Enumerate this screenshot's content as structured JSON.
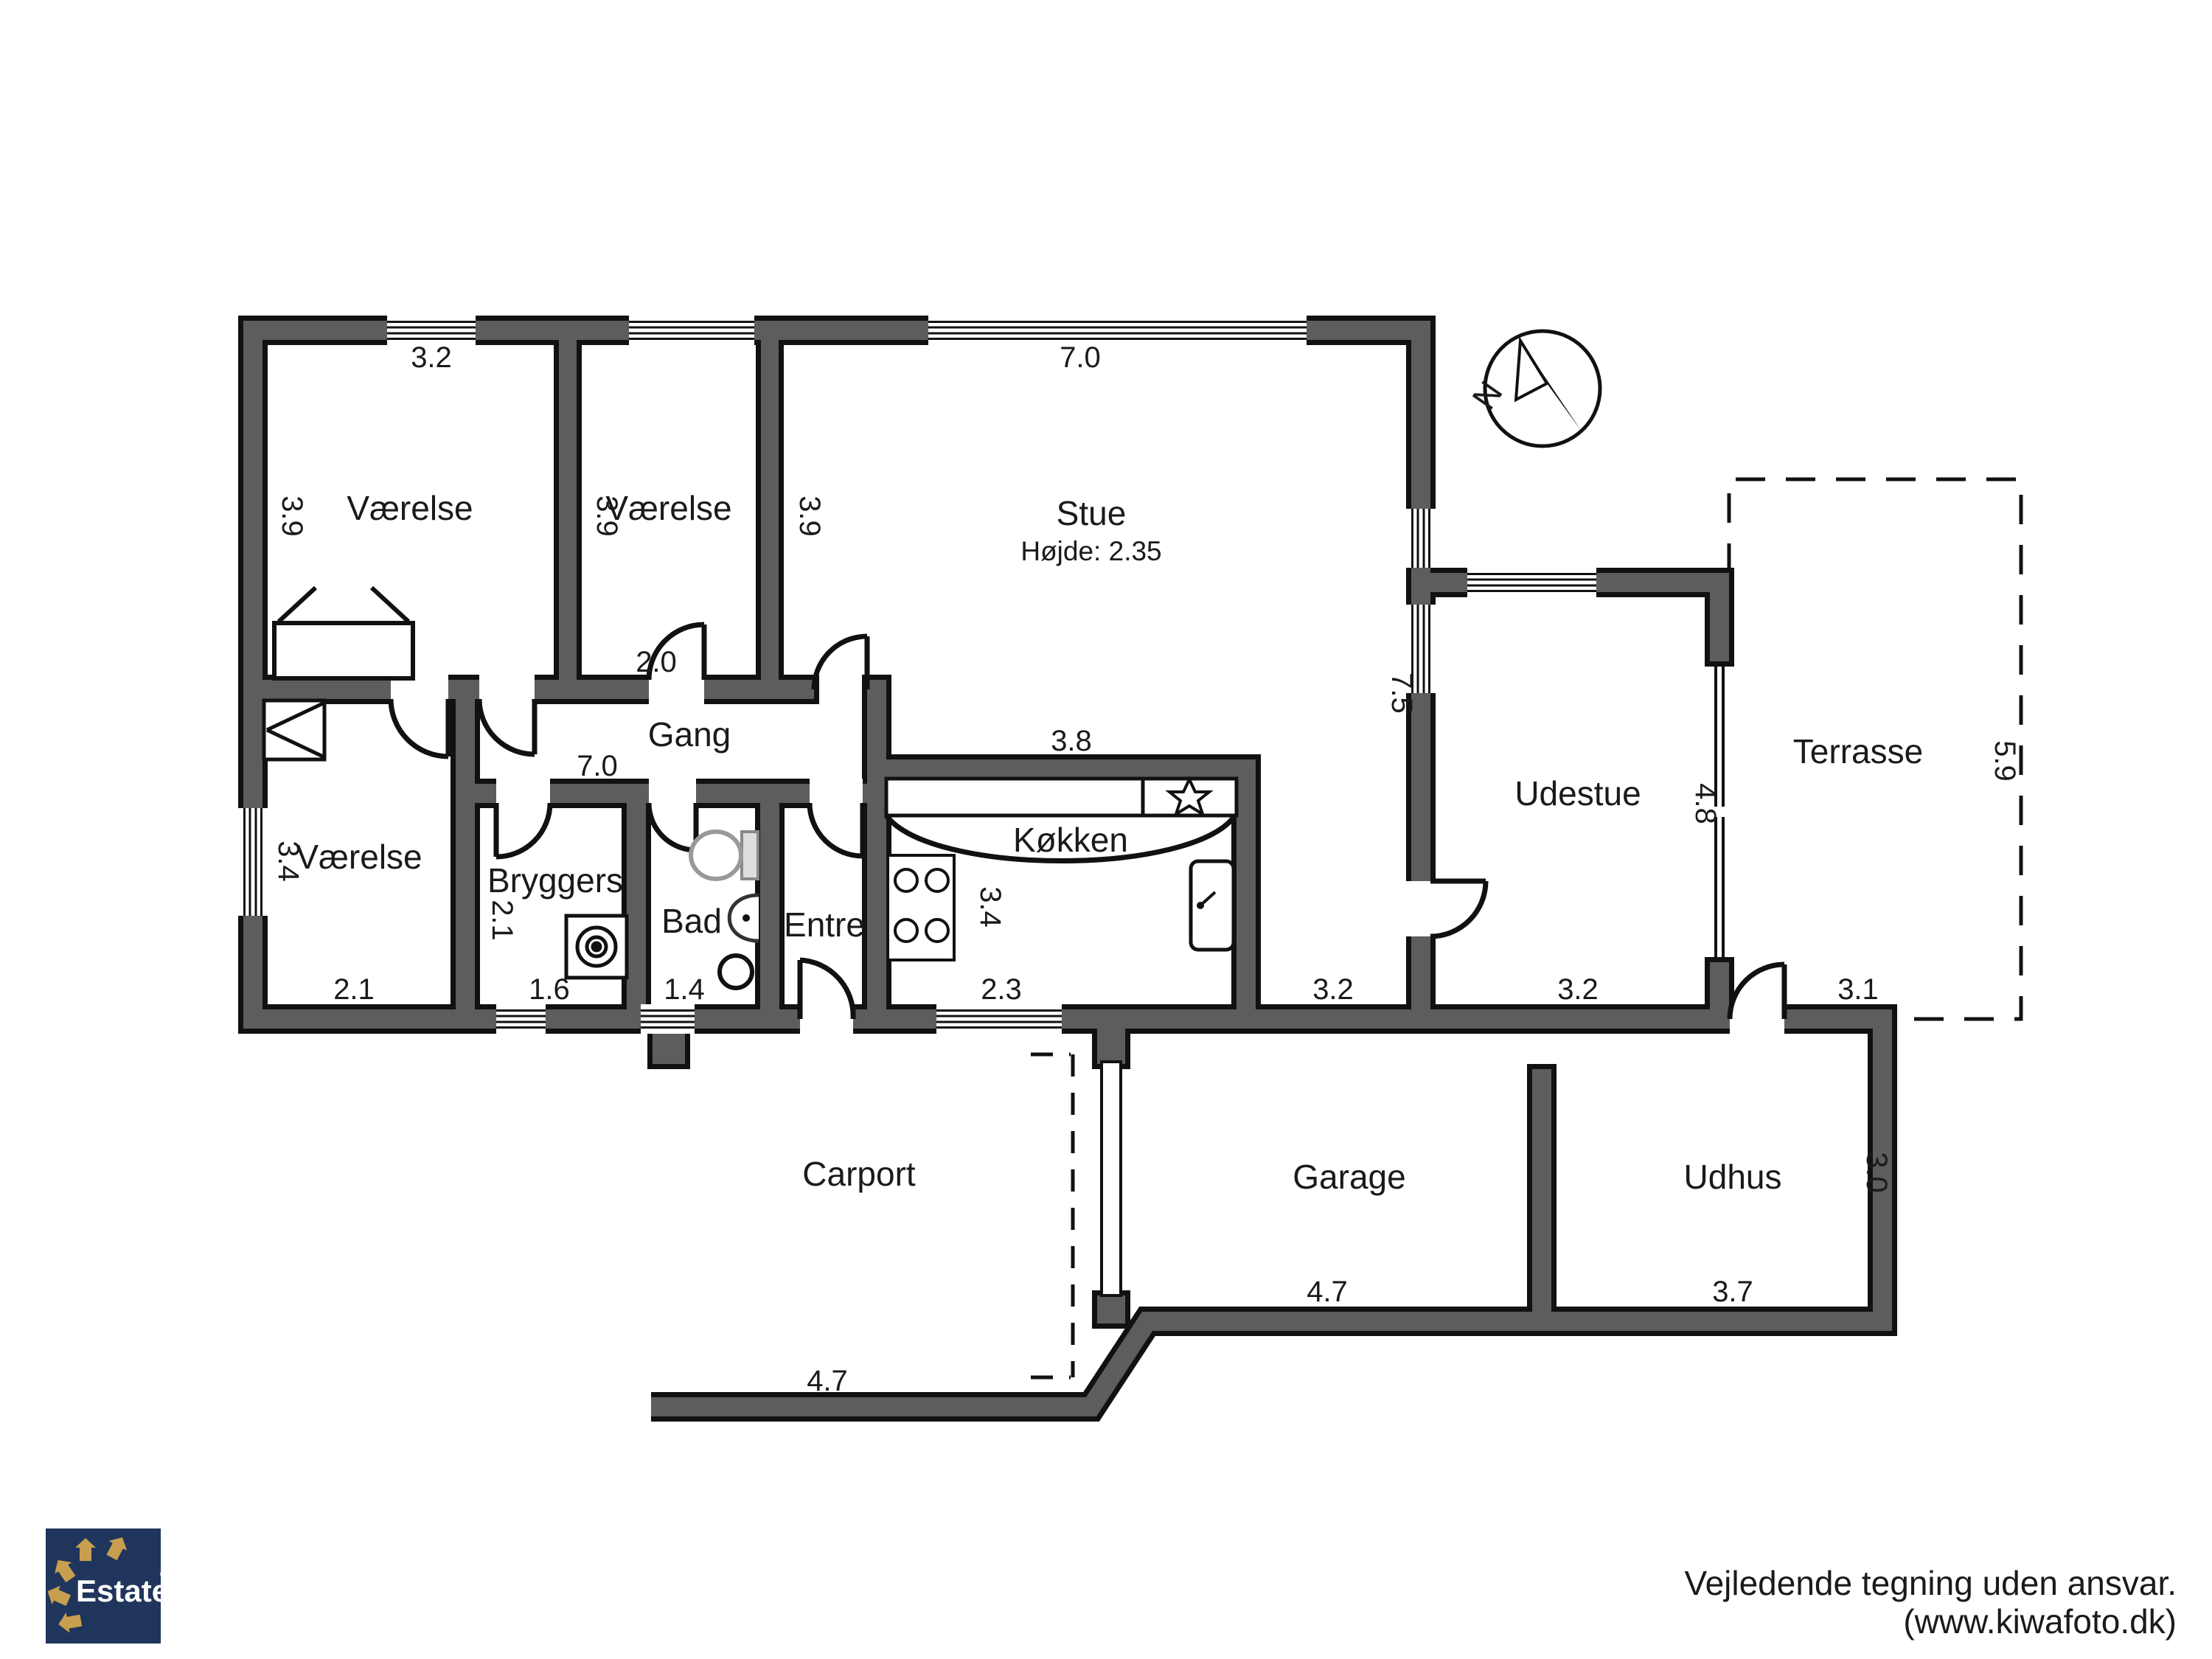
{
  "plan": {
    "rooms": {
      "vaerelse1": {
        "label": "Værelse",
        "width": "3.2",
        "depth": "3.9"
      },
      "vaerelse2": {
        "label": "Værelse",
        "width": "2.0",
        "depth": "3.9"
      },
      "stue": {
        "label": "Stue",
        "height_note": "Højde: 2.35",
        "width": "7.0",
        "depth_left": "3.9",
        "depth_right": "7.5",
        "bottom": "3.2"
      },
      "gang": {
        "label": "Gang",
        "width": "7.0"
      },
      "vaerelse3": {
        "label": "Værelse",
        "width": "2.1",
        "depth": "3.4"
      },
      "bryggers": {
        "label": "Bryggers",
        "width": "1.6",
        "depth": "2.1"
      },
      "bad": {
        "label": "Bad",
        "width": "1.4"
      },
      "entre": {
        "label": "Entre"
      },
      "koekken": {
        "label": "Køkken",
        "top": "3.8",
        "width": "2.3",
        "depth": "3.4"
      },
      "udestue": {
        "label": "Udestue",
        "width": "3.2",
        "depth": "4.8"
      },
      "terrasse": {
        "label": "Terrasse",
        "depth": "5.9",
        "bottom": "3.1"
      },
      "carport": {
        "label": "Carport",
        "drive": "4.7"
      },
      "garage": {
        "label": "Garage",
        "width": "4.7"
      },
      "udhus": {
        "label": "Udhus",
        "width": "3.7",
        "depth": "3.0"
      }
    },
    "compass": {
      "north": "N"
    }
  },
  "branding": {
    "logo_text": "Estate",
    "registered": "®"
  },
  "footer": {
    "line1": "Vejledende tegning uden ansvar.",
    "line2": "(www.kiwafoto.dk)"
  },
  "colors": {
    "wall_gray": "#5d5d5d",
    "outline_black": "#111111",
    "logo_navy": "#20355c",
    "logo_gold": "#c79f4e"
  }
}
